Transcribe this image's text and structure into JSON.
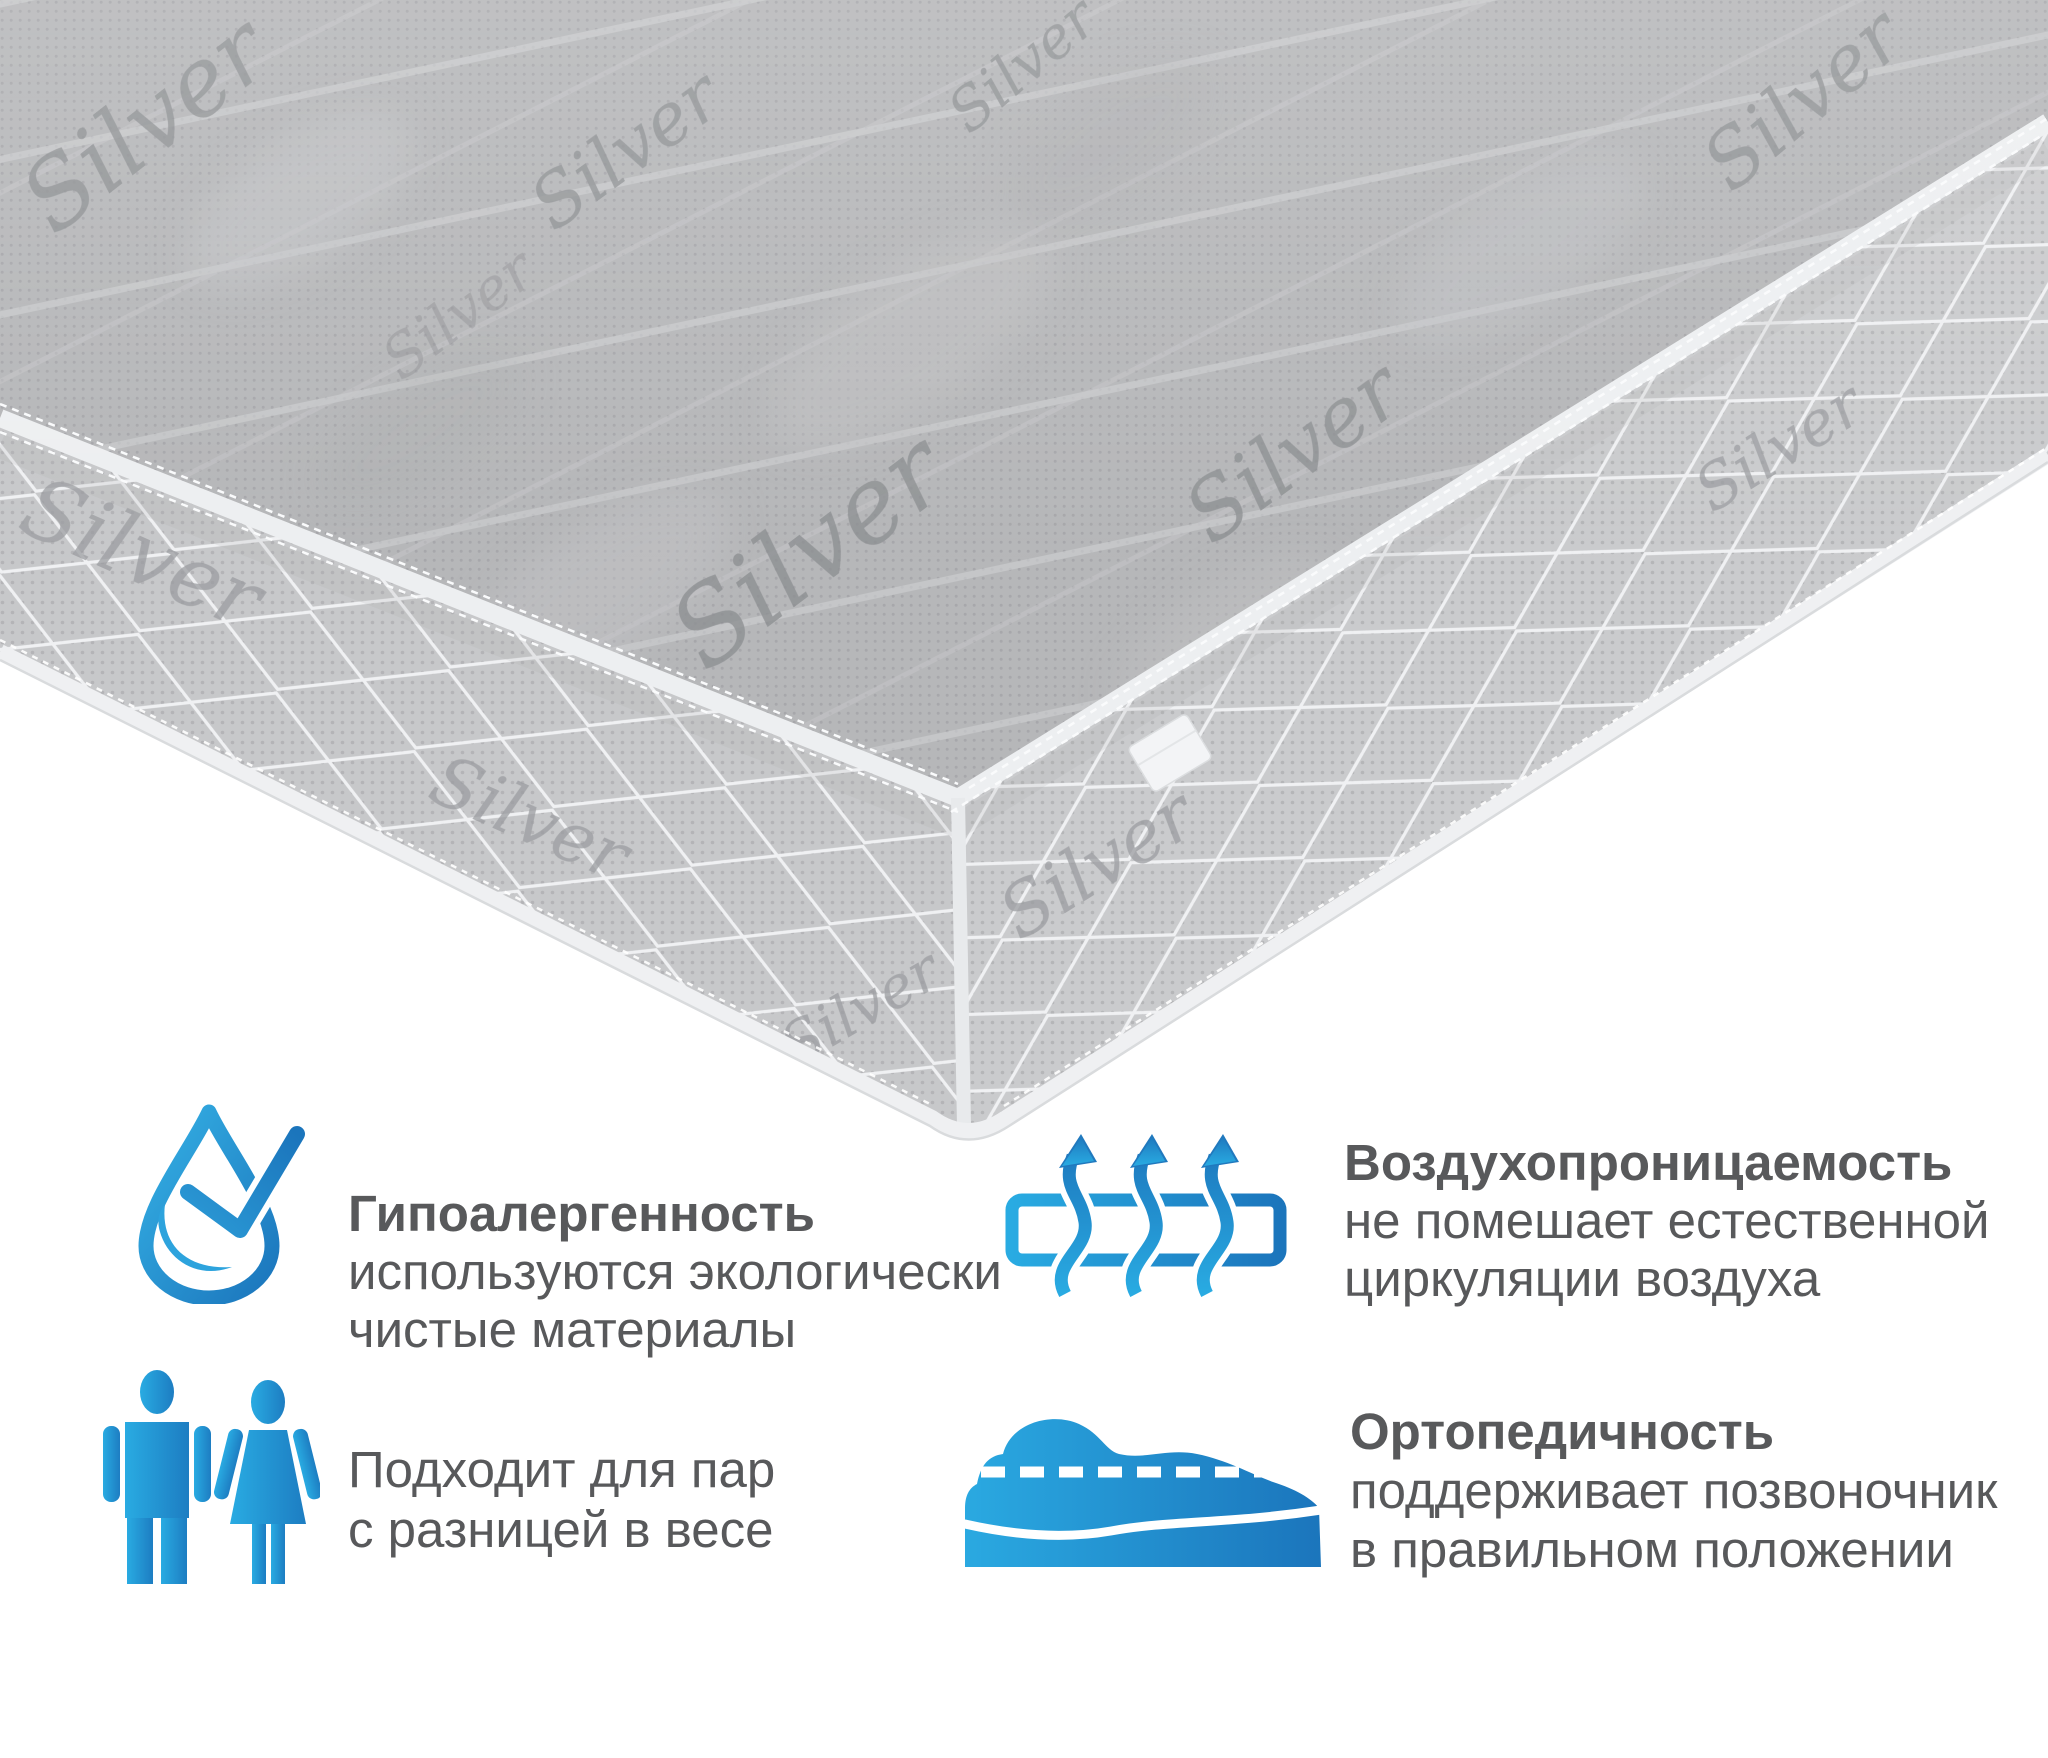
{
  "mattress": {
    "pattern_text": "Silver",
    "description": "gray quilted mattress corner view with Silver fabric print and white piping"
  },
  "features": [
    {
      "icon": "water-drop-check-icon",
      "title": "Гипоалергенность",
      "line1": "используются экологически",
      "line2": "чистые материалы"
    },
    {
      "icon": "airflow-arrows-icon",
      "title": "Воздухопроницаемость",
      "line1": "не помешает естественной",
      "line2": "циркуляции воздуха"
    },
    {
      "icon": "man-woman-couple-icon",
      "line1": "Подходит для пар",
      "line2": "с разницей в весе"
    },
    {
      "icon": "sleeping-person-on-mattress-icon",
      "title": "Ортопедичность",
      "line1": "поддерживает позвоночник",
      "line2": "в правильном положении"
    }
  ],
  "colors": {
    "accent_light": "#29ABE2",
    "accent_dark": "#1B75BC",
    "text": "#58595B",
    "mattress_top": "#B7B8BA",
    "mattress_band": "#C9CACC",
    "piping": "#EDEFF1",
    "background": "#FFFFFF"
  }
}
